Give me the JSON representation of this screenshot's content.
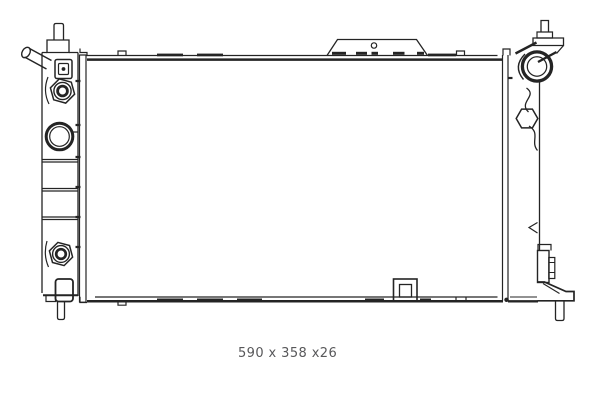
{
  "colors": {
    "background": "#ffffff",
    "line": "#242424",
    "caption": "#58585a"
  },
  "caption": {
    "dimensions": "590 x 358 x26"
  }
}
